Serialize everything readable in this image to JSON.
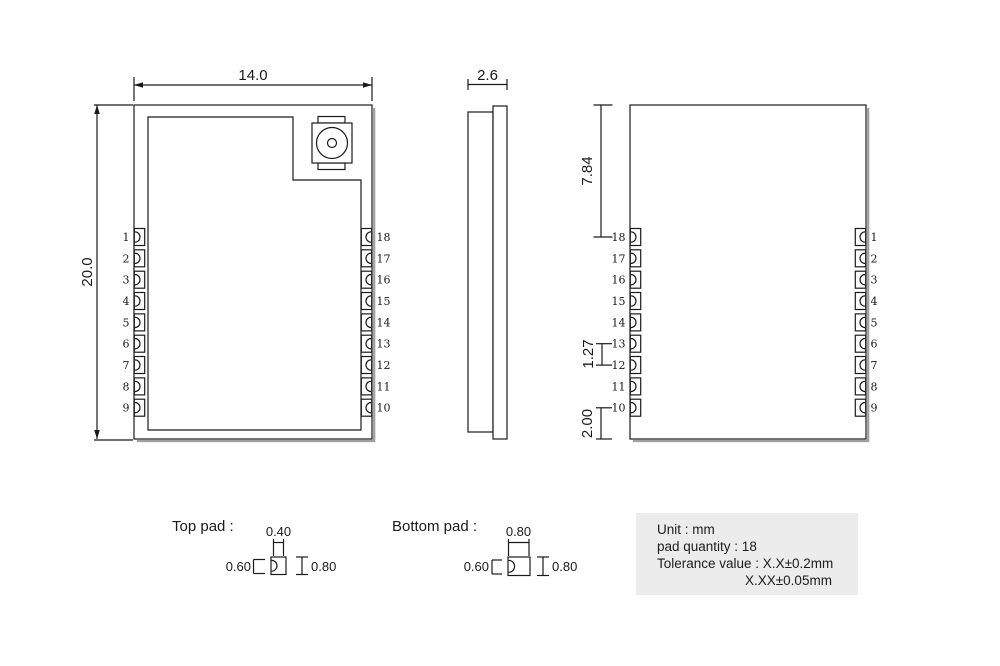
{
  "front_view": {
    "width_dim": "14.0",
    "height_dim": "20.0",
    "left_pins": [
      "1",
      "2",
      "3",
      "4",
      "5",
      "6",
      "7",
      "8",
      "9"
    ],
    "right_pins": [
      "18",
      "17",
      "16",
      "15",
      "14",
      "13",
      "12",
      "11",
      "10"
    ]
  },
  "side_view": {
    "thickness_dim": "2.6"
  },
  "back_view": {
    "top_offset_dim": "7.84",
    "pitch_dim": "1.27",
    "bottom_offset_dim": "2.00",
    "left_pins": [
      "18",
      "17",
      "16",
      "15",
      "14",
      "13",
      "12",
      "11",
      "10"
    ],
    "right_pins": [
      "1",
      "2",
      "3",
      "4",
      "5",
      "6",
      "7",
      "8",
      "9"
    ]
  },
  "pad_details": {
    "top_pad": {
      "label": "Top pad :",
      "notch_width_dim": "0.40",
      "height_dim": "0.60",
      "width_dim": "0.80"
    },
    "bottom_pad": {
      "label": "Bottom pad :",
      "notch_width_dim": "0.80",
      "height_dim": "0.60",
      "width_dim": "0.80"
    }
  },
  "info_box": {
    "lines": [
      "Unit : mm",
      "pad quantity : 18",
      "Tolerance value : X.X±0.2mm",
      "X.XX±0.05mm"
    ]
  },
  "colors": {
    "line": "#1a1a1a",
    "shadow": "#9f9f9f",
    "info_background": "#ececec"
  }
}
